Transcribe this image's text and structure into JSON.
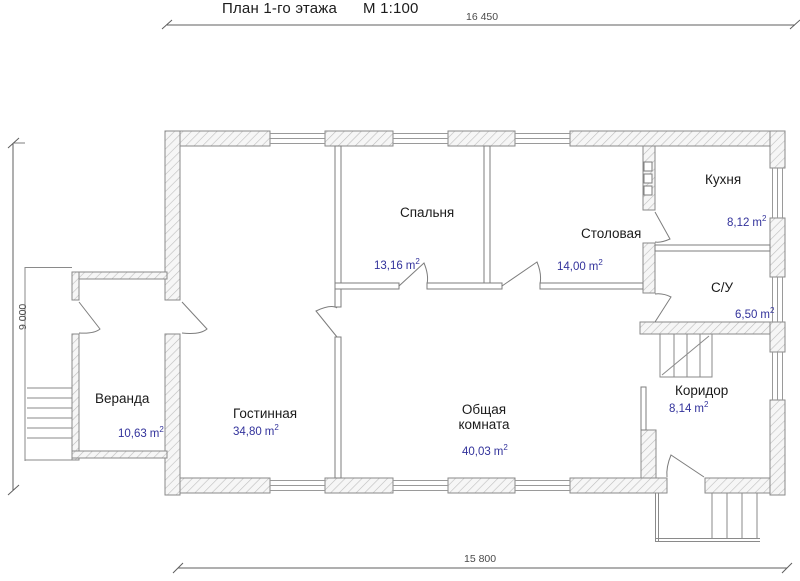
{
  "plan": {
    "title": "План 1-го этажа",
    "scale": "М 1:100",
    "area_unit": "m",
    "area_sup": "2"
  },
  "dimensions": {
    "top": "16 450",
    "bottom": "15 800",
    "left": "9 000"
  },
  "rooms": [
    {
      "name": "Спальня",
      "area": "13,16"
    },
    {
      "name": "Столовая",
      "area": "14,00"
    },
    {
      "name": "Кухня",
      "area": "8,12"
    },
    {
      "name": "С/У",
      "area": "6,50"
    },
    {
      "name": "Коридор",
      "area": "8,14"
    },
    {
      "name": "Общая комната",
      "area": "40,03"
    },
    {
      "name": "Гостинная",
      "area": "34,80"
    },
    {
      "name": "Веранда",
      "area": "10,63"
    }
  ],
  "colors": {
    "area_text": "#32329b",
    "label_text": "#1a1a1a",
    "wall_line": "#8a8a8a",
    "hatch_line": "#bdbdbd"
  }
}
